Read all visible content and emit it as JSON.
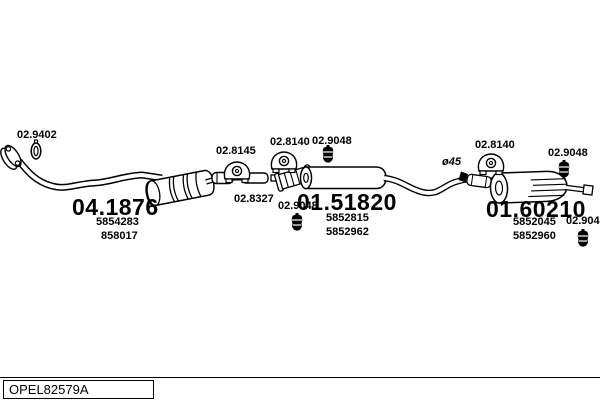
{
  "colors": {
    "line": "#000000",
    "background": "#ffffff"
  },
  "footer": {
    "code": "OPEL82579A"
  },
  "parts": {
    "front_pipe": {
      "part_no": "04.1876",
      "oem": [
        "5854283",
        "858017"
      ]
    },
    "center_muffler": {
      "part_no": "01.51820",
      "oem": [
        "5852815",
        "5852962"
      ]
    },
    "rear_muffler": {
      "part_no": "01.60210",
      "oem": [
        "5852045",
        "5852960"
      ]
    }
  },
  "callouts": {
    "clamp_front": "02.9402",
    "hanger_front": "02.8145",
    "sleeve": "02.8327",
    "hanger_mid": "02.8140",
    "mount_top_mid": "02.9048",
    "mount_bot_mid": "02.9048",
    "diameter": "ø45",
    "hanger_rear": "02.8140",
    "mount_top_rear": "02.9048",
    "mount_bot_rear": "02.9048"
  }
}
